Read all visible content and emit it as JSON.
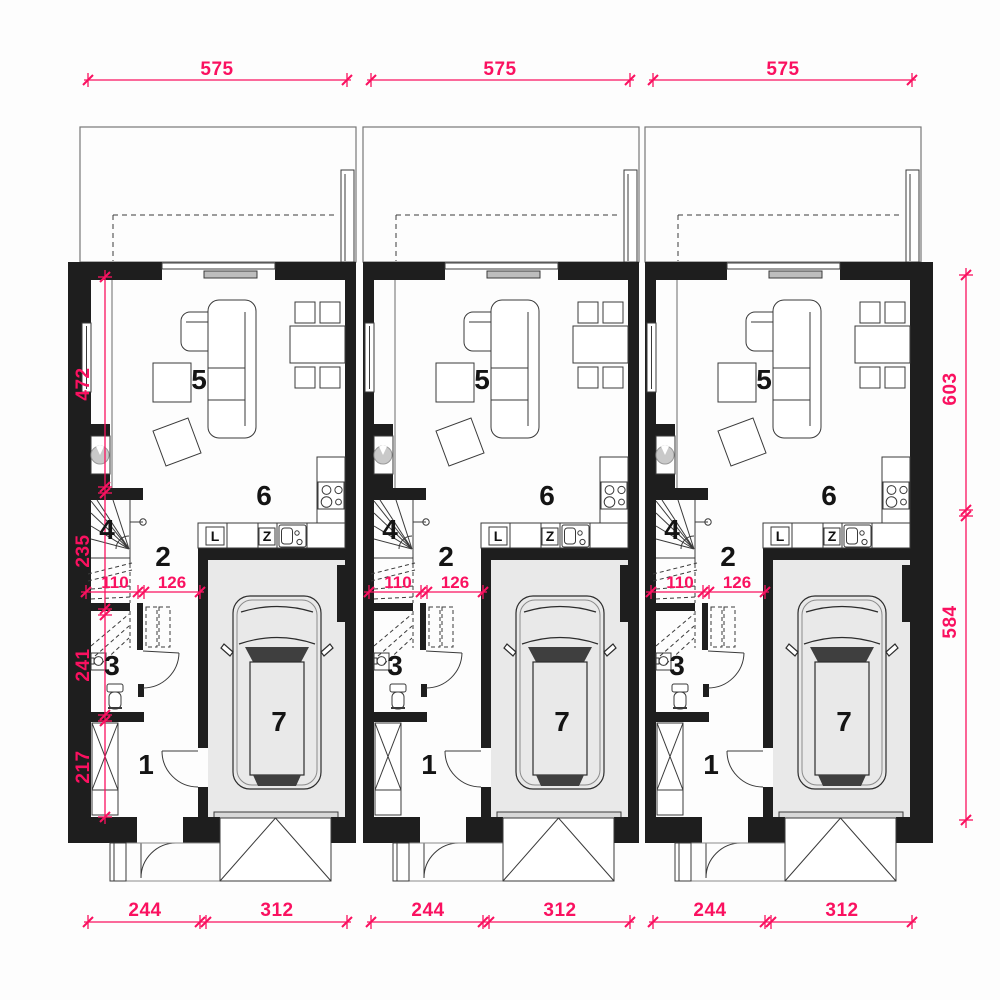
{
  "colors": {
    "dimension_pink": "#fa1160",
    "wall_black": "#1e1e1e",
    "garage_floor_gray": "#e9e9e9"
  },
  "dimensions": {
    "top_widths": [
      "575",
      "575",
      "575"
    ],
    "left_heights": [
      "472",
      "235",
      "241",
      "217"
    ],
    "right_heights": [
      "603",
      "584"
    ],
    "bottom_widths": [
      "244",
      "312",
      "244",
      "312",
      "244",
      "312"
    ]
  },
  "units": [
    {
      "id": "unit-1",
      "room_numbers": {
        "entry": "1",
        "hall": "2",
        "bath": "3",
        "stairs": "4",
        "living": "5",
        "kitchen": "6",
        "garage": "7"
      },
      "kitchen_labels": {
        "fridge": "L",
        "sink": "Z"
      },
      "hall_dims": [
        "110",
        "126"
      ]
    },
    {
      "id": "unit-2",
      "room_numbers": {
        "entry": "1",
        "hall": "2",
        "bath": "3",
        "stairs": "4",
        "living": "5",
        "kitchen": "6",
        "garage": "7"
      },
      "kitchen_labels": {
        "fridge": "L",
        "sink": "Z"
      },
      "hall_dims": [
        "110",
        "126"
      ]
    },
    {
      "id": "unit-3",
      "room_numbers": {
        "entry": "1",
        "hall": "2",
        "bath": "3",
        "stairs": "4",
        "living": "5",
        "kitchen": "6",
        "garage": "7"
      },
      "kitchen_labels": {
        "fridge": "L",
        "sink": "Z"
      },
      "hall_dims": [
        "110",
        "126"
      ]
    }
  ]
}
